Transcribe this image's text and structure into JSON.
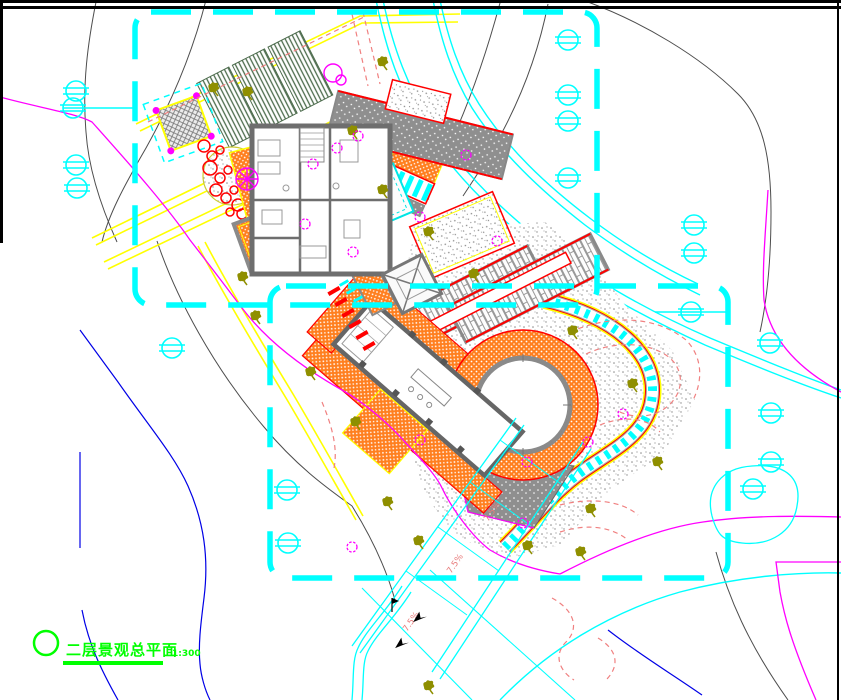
{
  "drawing": {
    "title": "二层景观总平面",
    "scale": "1:300",
    "slope_labels": [
      "7.5%",
      "7.5%",
      "7.5%"
    ]
  },
  "palette": {
    "boundary_cyan": "#00FFFF",
    "road_yellow": "#FFFF00",
    "paving_orange": "#FF7F1F",
    "accent_red": "#FF0000",
    "planting_green": "#4C6B4C",
    "plant_olive": "#8F8F00",
    "contour_magenta": "#FF00FF",
    "contour_gray": "#4D4D4D",
    "contour_blue": "#0000E6",
    "contour_salmon": "#F08080",
    "title_green": "#00FF00",
    "wall_gray": "#6E6E6E"
  }
}
